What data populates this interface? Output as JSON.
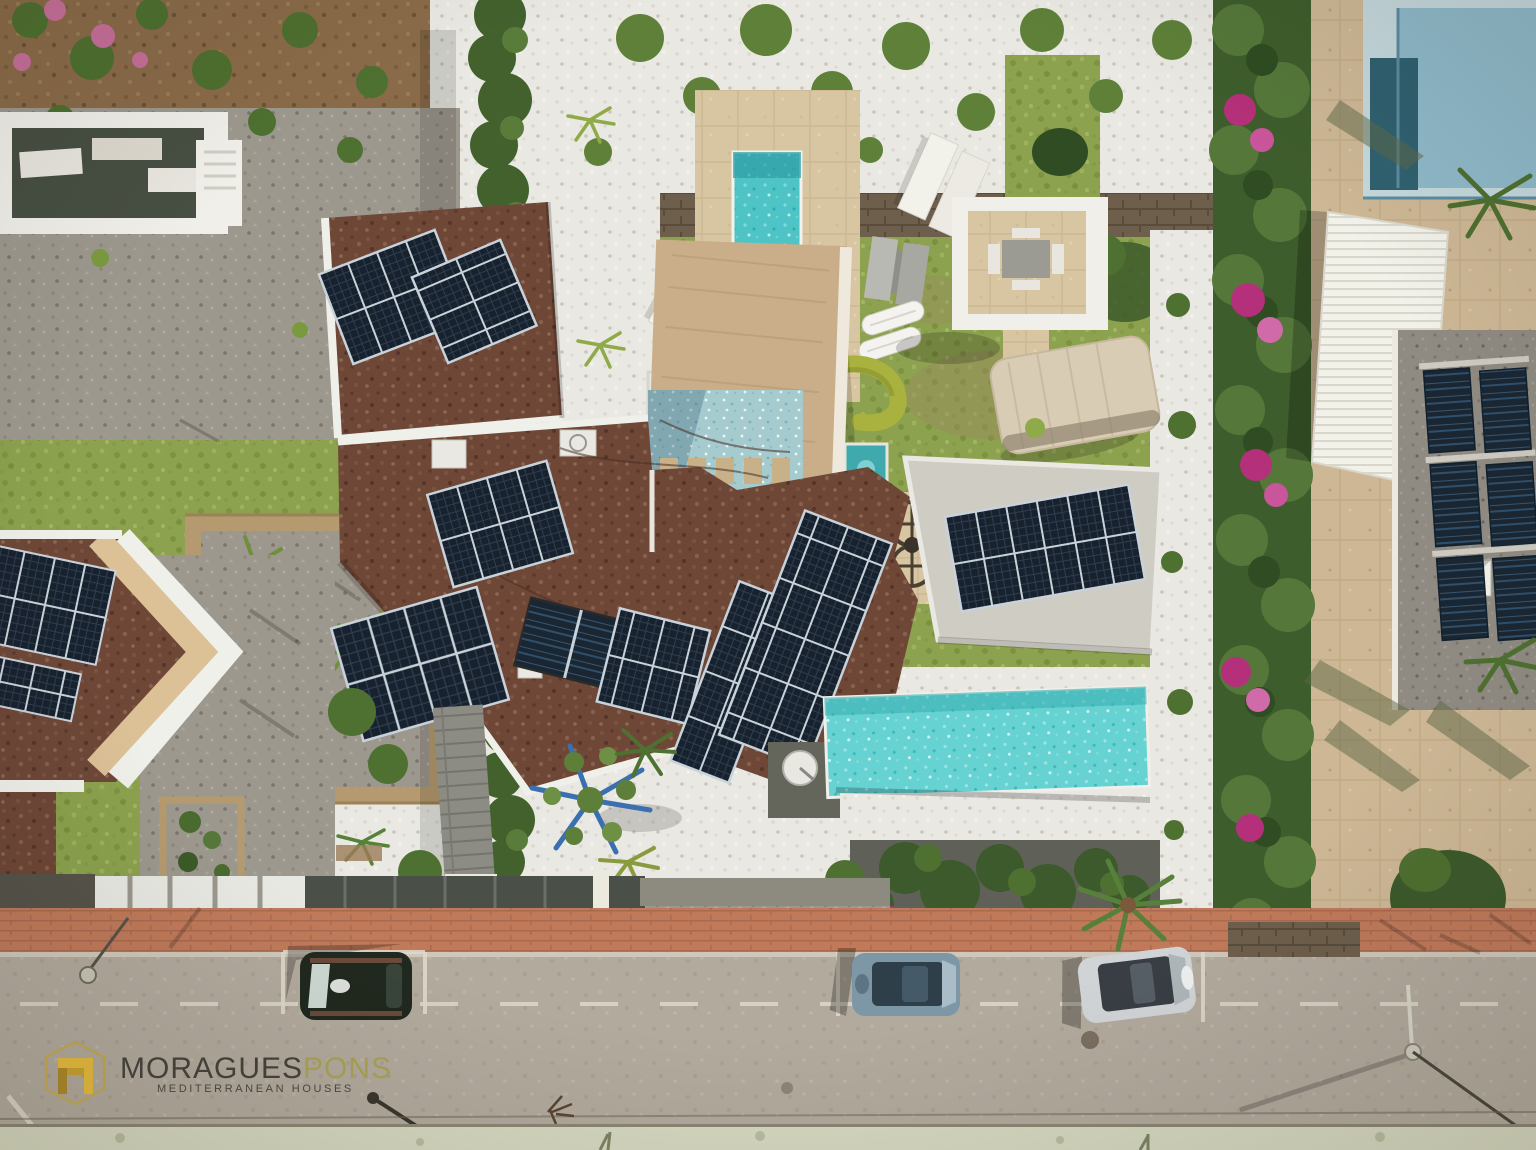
{
  "watermark": {
    "brand_primary": "MORAGUES",
    "brand_secondary": "PONS",
    "tagline": "MEDITERRANEAN HOUSES"
  },
  "palette": {
    "asphalt": "#b2aa9d",
    "sidewalk_brick": "#c07a5a",
    "verge": "#d6d8c0",
    "road_marking": "#ddd8ca",
    "lawn": "#8ca24e",
    "white_gravel": "#e9e8e2",
    "gray_gravel": "#9d988e",
    "dirt": "#8a6b49",
    "cypress": "#42612c",
    "hedge_green": "#4c7031",
    "bougainvillea": "#b5307a",
    "roof_brown": "#6e4737",
    "solar_panel": "#18222e",
    "solar_frame": "#c8d2da",
    "thermal_panel": "#1a2733",
    "pool_turquoise": "#4fc4c6",
    "infinity_pool": "#66d2d2",
    "jacuzzi": "#3fa9ad",
    "mosaic_tile": "#a5cbcf",
    "pool_deck_beige": "#d8c6a2",
    "travertine": "#cdb795",
    "tan_shed": "#c9ae89",
    "white_structure": "#f0efe9",
    "pale_roof": "#cfccc3",
    "gravel_roof": "#8f8b82",
    "wall_stone": "#6b5c49",
    "neighbor_pool_blue": "#8fb9c9",
    "neighbor_pool_navy": "#30606f",
    "car_dark_green": "#20291f",
    "car_steel_blue": "#7e97a7",
    "car_silver": "#d0d4d6",
    "logo_gold_bright": "#d2ab38",
    "logo_gold_dark": "#9d7d28",
    "logo_hex_stroke": "#b29a4e",
    "logo_text_dark": "#43403a",
    "logo_text_gold": "#a39b52"
  },
  "scene": {
    "type": "aerial-drone-photo",
    "parked_cars": [
      {
        "color_name": "dark-green"
      },
      {
        "color_name": "steel-blue"
      },
      {
        "color_name": "silver"
      }
    ],
    "main_villa": {
      "solar_arrays": 9,
      "water_features": [
        "lap-pool",
        "infinity-pool",
        "jacuzzi",
        "mosaic-terrace"
      ],
      "garden": [
        "lawn",
        "pergola",
        "sun-loungers",
        "paddle-boards",
        "curved-hedge"
      ]
    },
    "neighbors": [
      "white-villa-left",
      "chevron-villa-bottom-left",
      "gravel-roof-villa-right"
    ],
    "street": [
      "brick-sidewalk",
      "asphalt-road",
      "dashed-lane-marking",
      "street-lamps"
    ]
  }
}
